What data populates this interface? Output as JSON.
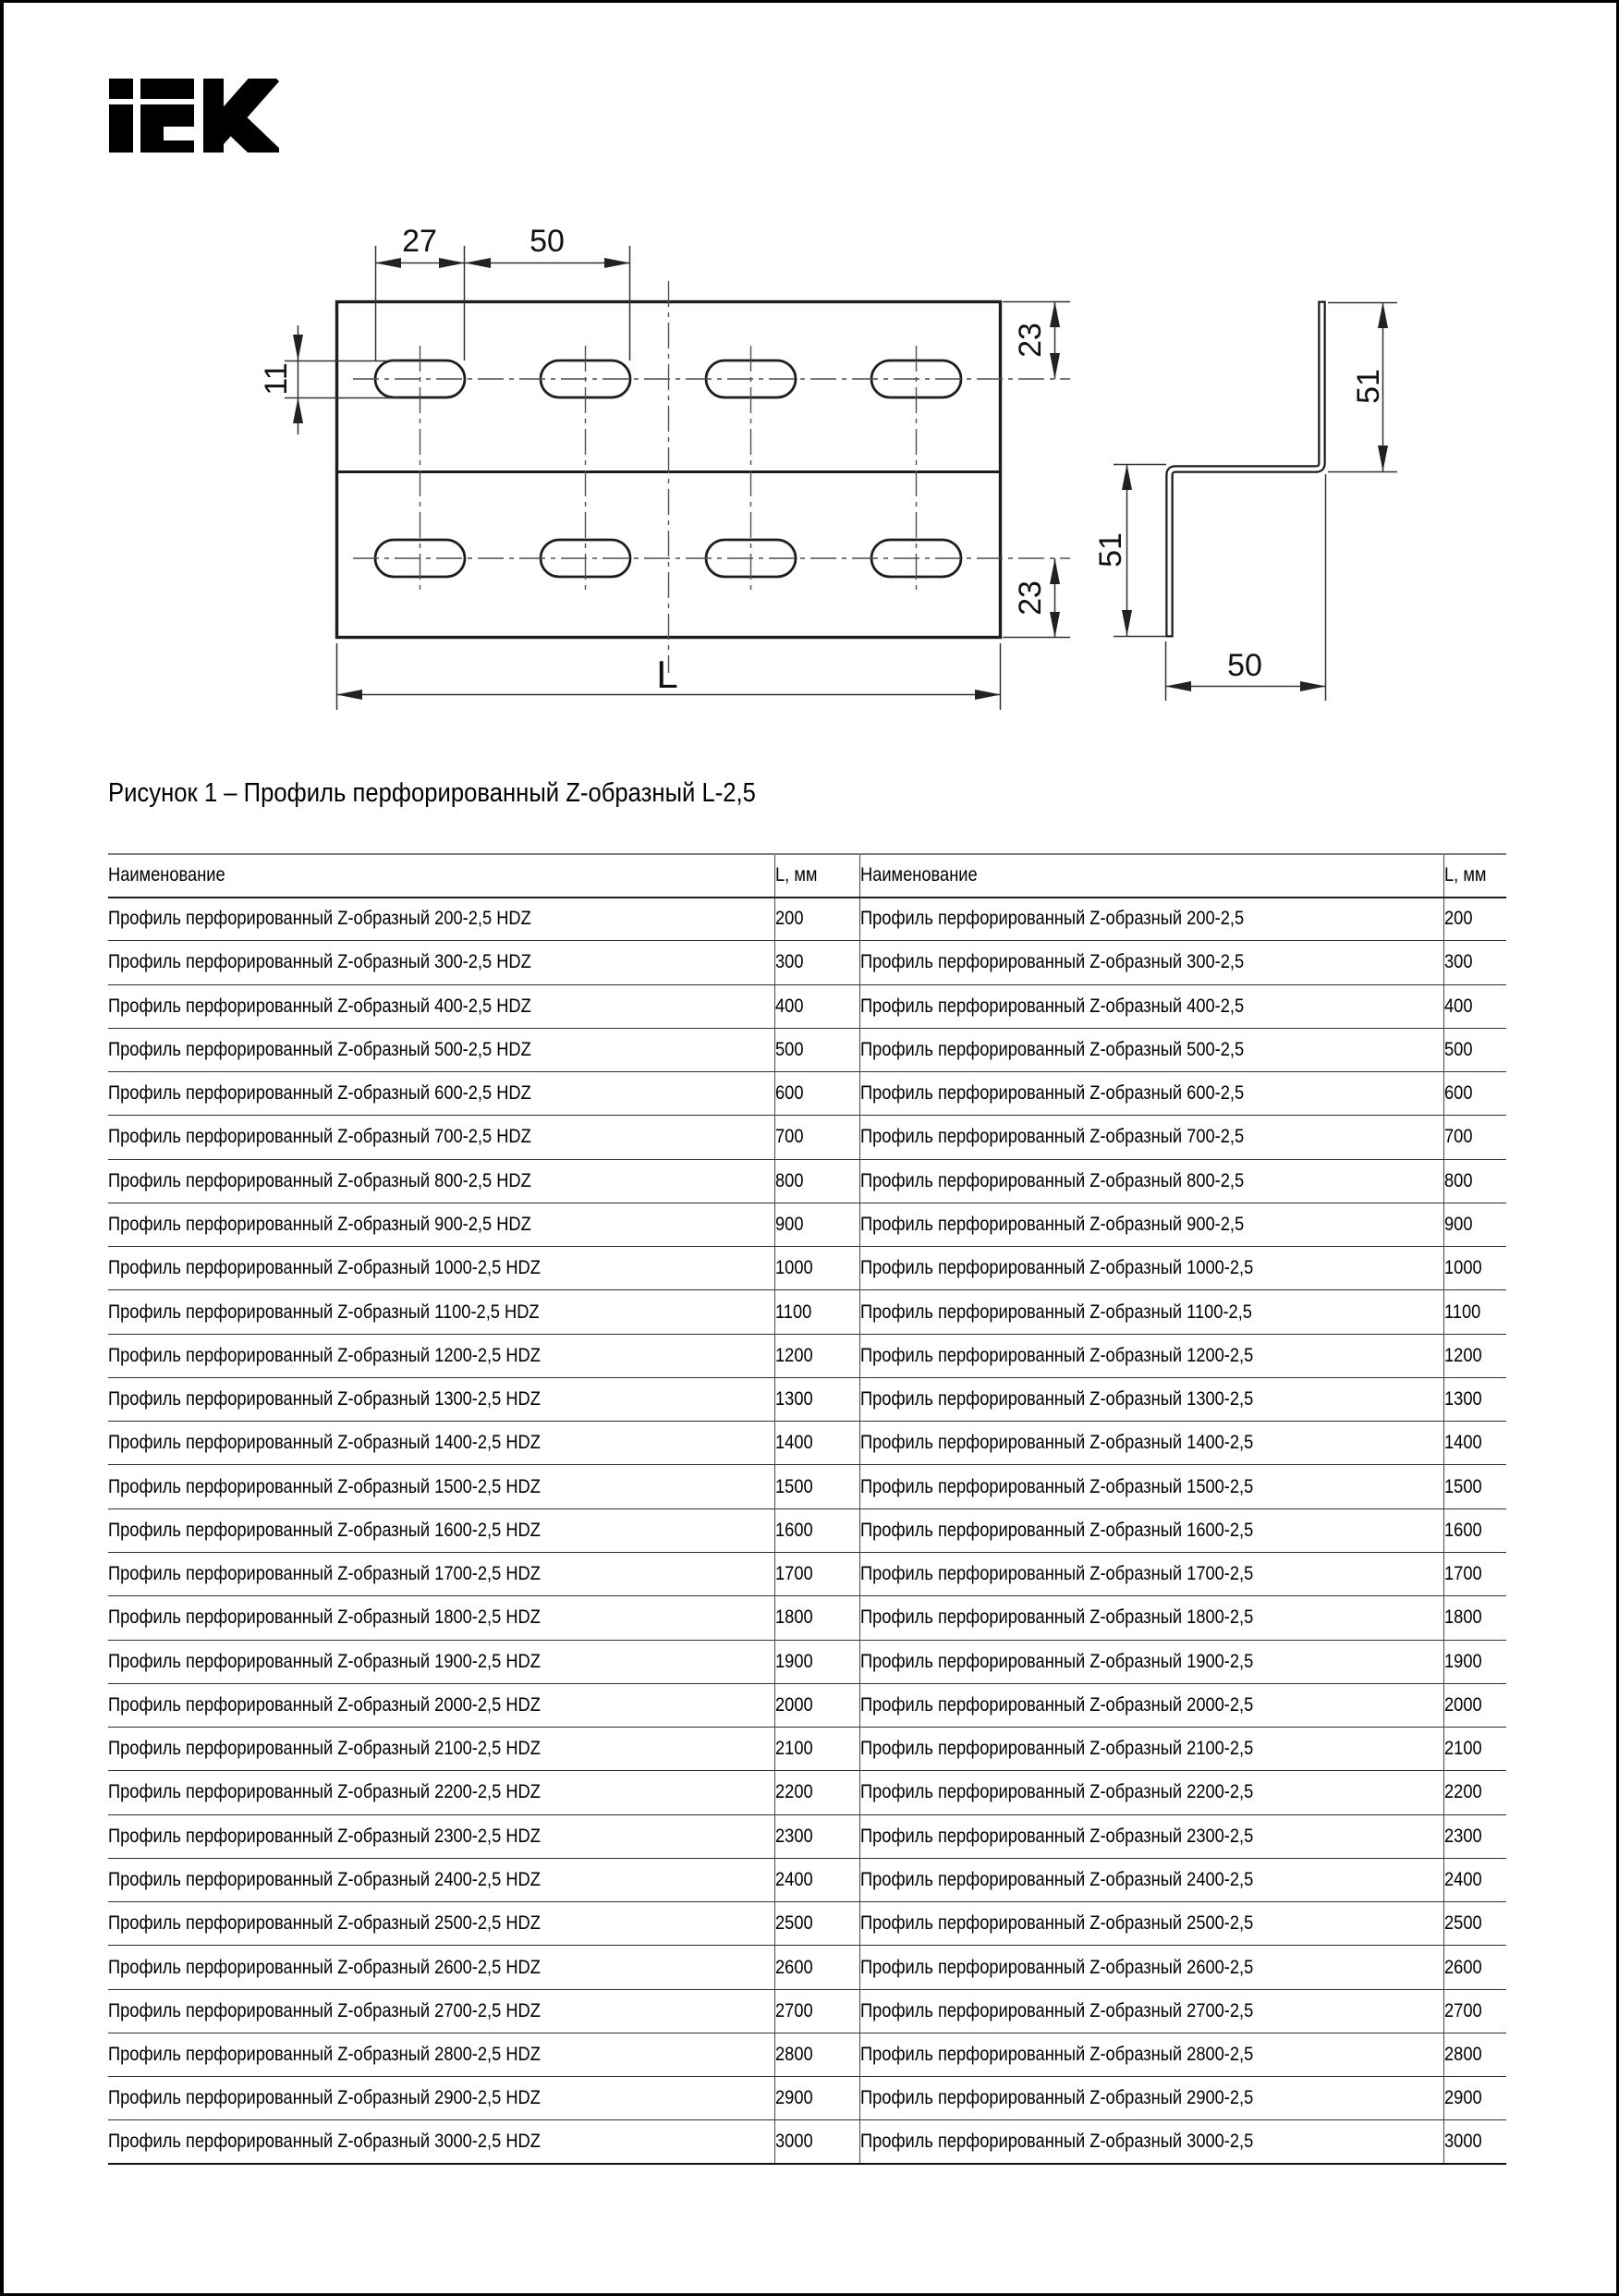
{
  "page": {
    "brand": "IEK"
  },
  "figure": {
    "caption": "Рисунок 1 – Профиль перфорированный Z-образный L-2,5",
    "dims": {
      "slot_length": "27",
      "slot_pitch": "50",
      "slot_width": "11",
      "edge_offset_top": "23",
      "edge_offset_bottom": "23",
      "length_label": "L",
      "flange_right": "51",
      "flange_left": "51",
      "web_width": "50"
    }
  },
  "table": {
    "headers": [
      "Наименование",
      "L, мм",
      "Наименование",
      "L, мм"
    ],
    "rows": [
      [
        "Профиль перфорированный Z-образный 200-2,5 HDZ",
        "200",
        "Профиль перфорированный Z-образный 200-2,5",
        "200"
      ],
      [
        "Профиль перфорированный Z-образный 300-2,5 HDZ",
        "300",
        "Профиль перфорированный Z-образный 300-2,5",
        "300"
      ],
      [
        "Профиль перфорированный Z-образный 400-2,5 HDZ",
        "400",
        "Профиль перфорированный Z-образный 400-2,5",
        "400"
      ],
      [
        "Профиль перфорированный Z-образный 500-2,5 HDZ",
        "500",
        "Профиль перфорированный Z-образный 500-2,5",
        "500"
      ],
      [
        "Профиль перфорированный Z-образный 600-2,5 HDZ",
        "600",
        "Профиль перфорированный Z-образный 600-2,5",
        "600"
      ],
      [
        "Профиль перфорированный Z-образный 700-2,5 HDZ",
        "700",
        "Профиль перфорированный Z-образный 700-2,5",
        "700"
      ],
      [
        "Профиль перфорированный Z-образный 800-2,5 HDZ",
        "800",
        "Профиль перфорированный Z-образный 800-2,5",
        "800"
      ],
      [
        "Профиль перфорированный Z-образный 900-2,5 HDZ",
        "900",
        "Профиль перфорированный Z-образный 900-2,5",
        "900"
      ],
      [
        "Профиль перфорированный Z-образный 1000-2,5 HDZ",
        "1000",
        "Профиль перфорированный Z-образный 1000-2,5",
        "1000"
      ],
      [
        "Профиль перфорированный Z-образный 1100-2,5 HDZ",
        "1100",
        "Профиль перфорированный Z-образный 1100-2,5",
        "1100"
      ],
      [
        "Профиль перфорированный Z-образный 1200-2,5 HDZ",
        "1200",
        "Профиль перфорированный Z-образный 1200-2,5",
        "1200"
      ],
      [
        "Профиль перфорированный Z-образный 1300-2,5 HDZ",
        "1300",
        "Профиль перфорированный Z-образный 1300-2,5",
        "1300"
      ],
      [
        "Профиль перфорированный Z-образный 1400-2,5 HDZ",
        "1400",
        "Профиль перфорированный Z-образный 1400-2,5",
        "1400"
      ],
      [
        "Профиль перфорированный Z-образный 1500-2,5 HDZ",
        "1500",
        "Профиль перфорированный Z-образный 1500-2,5",
        "1500"
      ],
      [
        "Профиль перфорированный Z-образный 1600-2,5 HDZ",
        "1600",
        "Профиль перфорированный Z-образный 1600-2,5",
        "1600"
      ],
      [
        "Профиль перфорированный Z-образный 1700-2,5 HDZ",
        "1700",
        "Профиль перфорированный Z-образный 1700-2,5",
        "1700"
      ],
      [
        "Профиль перфорированный Z-образный 1800-2,5 HDZ",
        "1800",
        "Профиль перфорированный Z-образный 1800-2,5",
        "1800"
      ],
      [
        "Профиль перфорированный Z-образный 1900-2,5 HDZ",
        "1900",
        "Профиль перфорированный Z-образный 1900-2,5",
        "1900"
      ],
      [
        "Профиль перфорированный Z-образный 2000-2,5 HDZ",
        "2000",
        "Профиль перфорированный Z-образный 2000-2,5",
        "2000"
      ],
      [
        "Профиль перфорированный Z-образный 2100-2,5 HDZ",
        "2100",
        "Профиль перфорированный Z-образный 2100-2,5",
        "2100"
      ],
      [
        "Профиль перфорированный Z-образный 2200-2,5 HDZ",
        "2200",
        "Профиль перфорированный Z-образный 2200-2,5",
        "2200"
      ],
      [
        "Профиль перфорированный Z-образный 2300-2,5 HDZ",
        "2300",
        "Профиль перфорированный Z-образный 2300-2,5",
        "2300"
      ],
      [
        "Профиль перфорированный Z-образный 2400-2,5 HDZ",
        "2400",
        "Профиль перфорированный Z-образный 2400-2,5",
        "2400"
      ],
      [
        "Профиль перфорированный Z-образный 2500-2,5 HDZ",
        "2500",
        "Профиль перфорированный Z-образный 2500-2,5",
        "2500"
      ],
      [
        "Профиль перфорированный Z-образный 2600-2,5 HDZ",
        "2600",
        "Профиль перфорированный Z-образный 2600-2,5",
        "2600"
      ],
      [
        "Профиль перфорированный Z-образный 2700-2,5 HDZ",
        "2700",
        "Профиль перфорированный Z-образный 2700-2,5",
        "2700"
      ],
      [
        "Профиль перфорированный Z-образный 2800-2,5 HDZ",
        "2800",
        "Профиль перфорированный Z-образный 2800-2,5",
        "2800"
      ],
      [
        "Профиль перфорированный Z-образный 2900-2,5 HDZ",
        "2900",
        "Профиль перфорированный Z-образный 2900-2,5",
        "2900"
      ],
      [
        "Профиль перфорированный Z-образный 3000-2,5 HDZ",
        "3000",
        "Профиль перфорированный Z-образный 3000-2,5",
        "3000"
      ]
    ]
  }
}
